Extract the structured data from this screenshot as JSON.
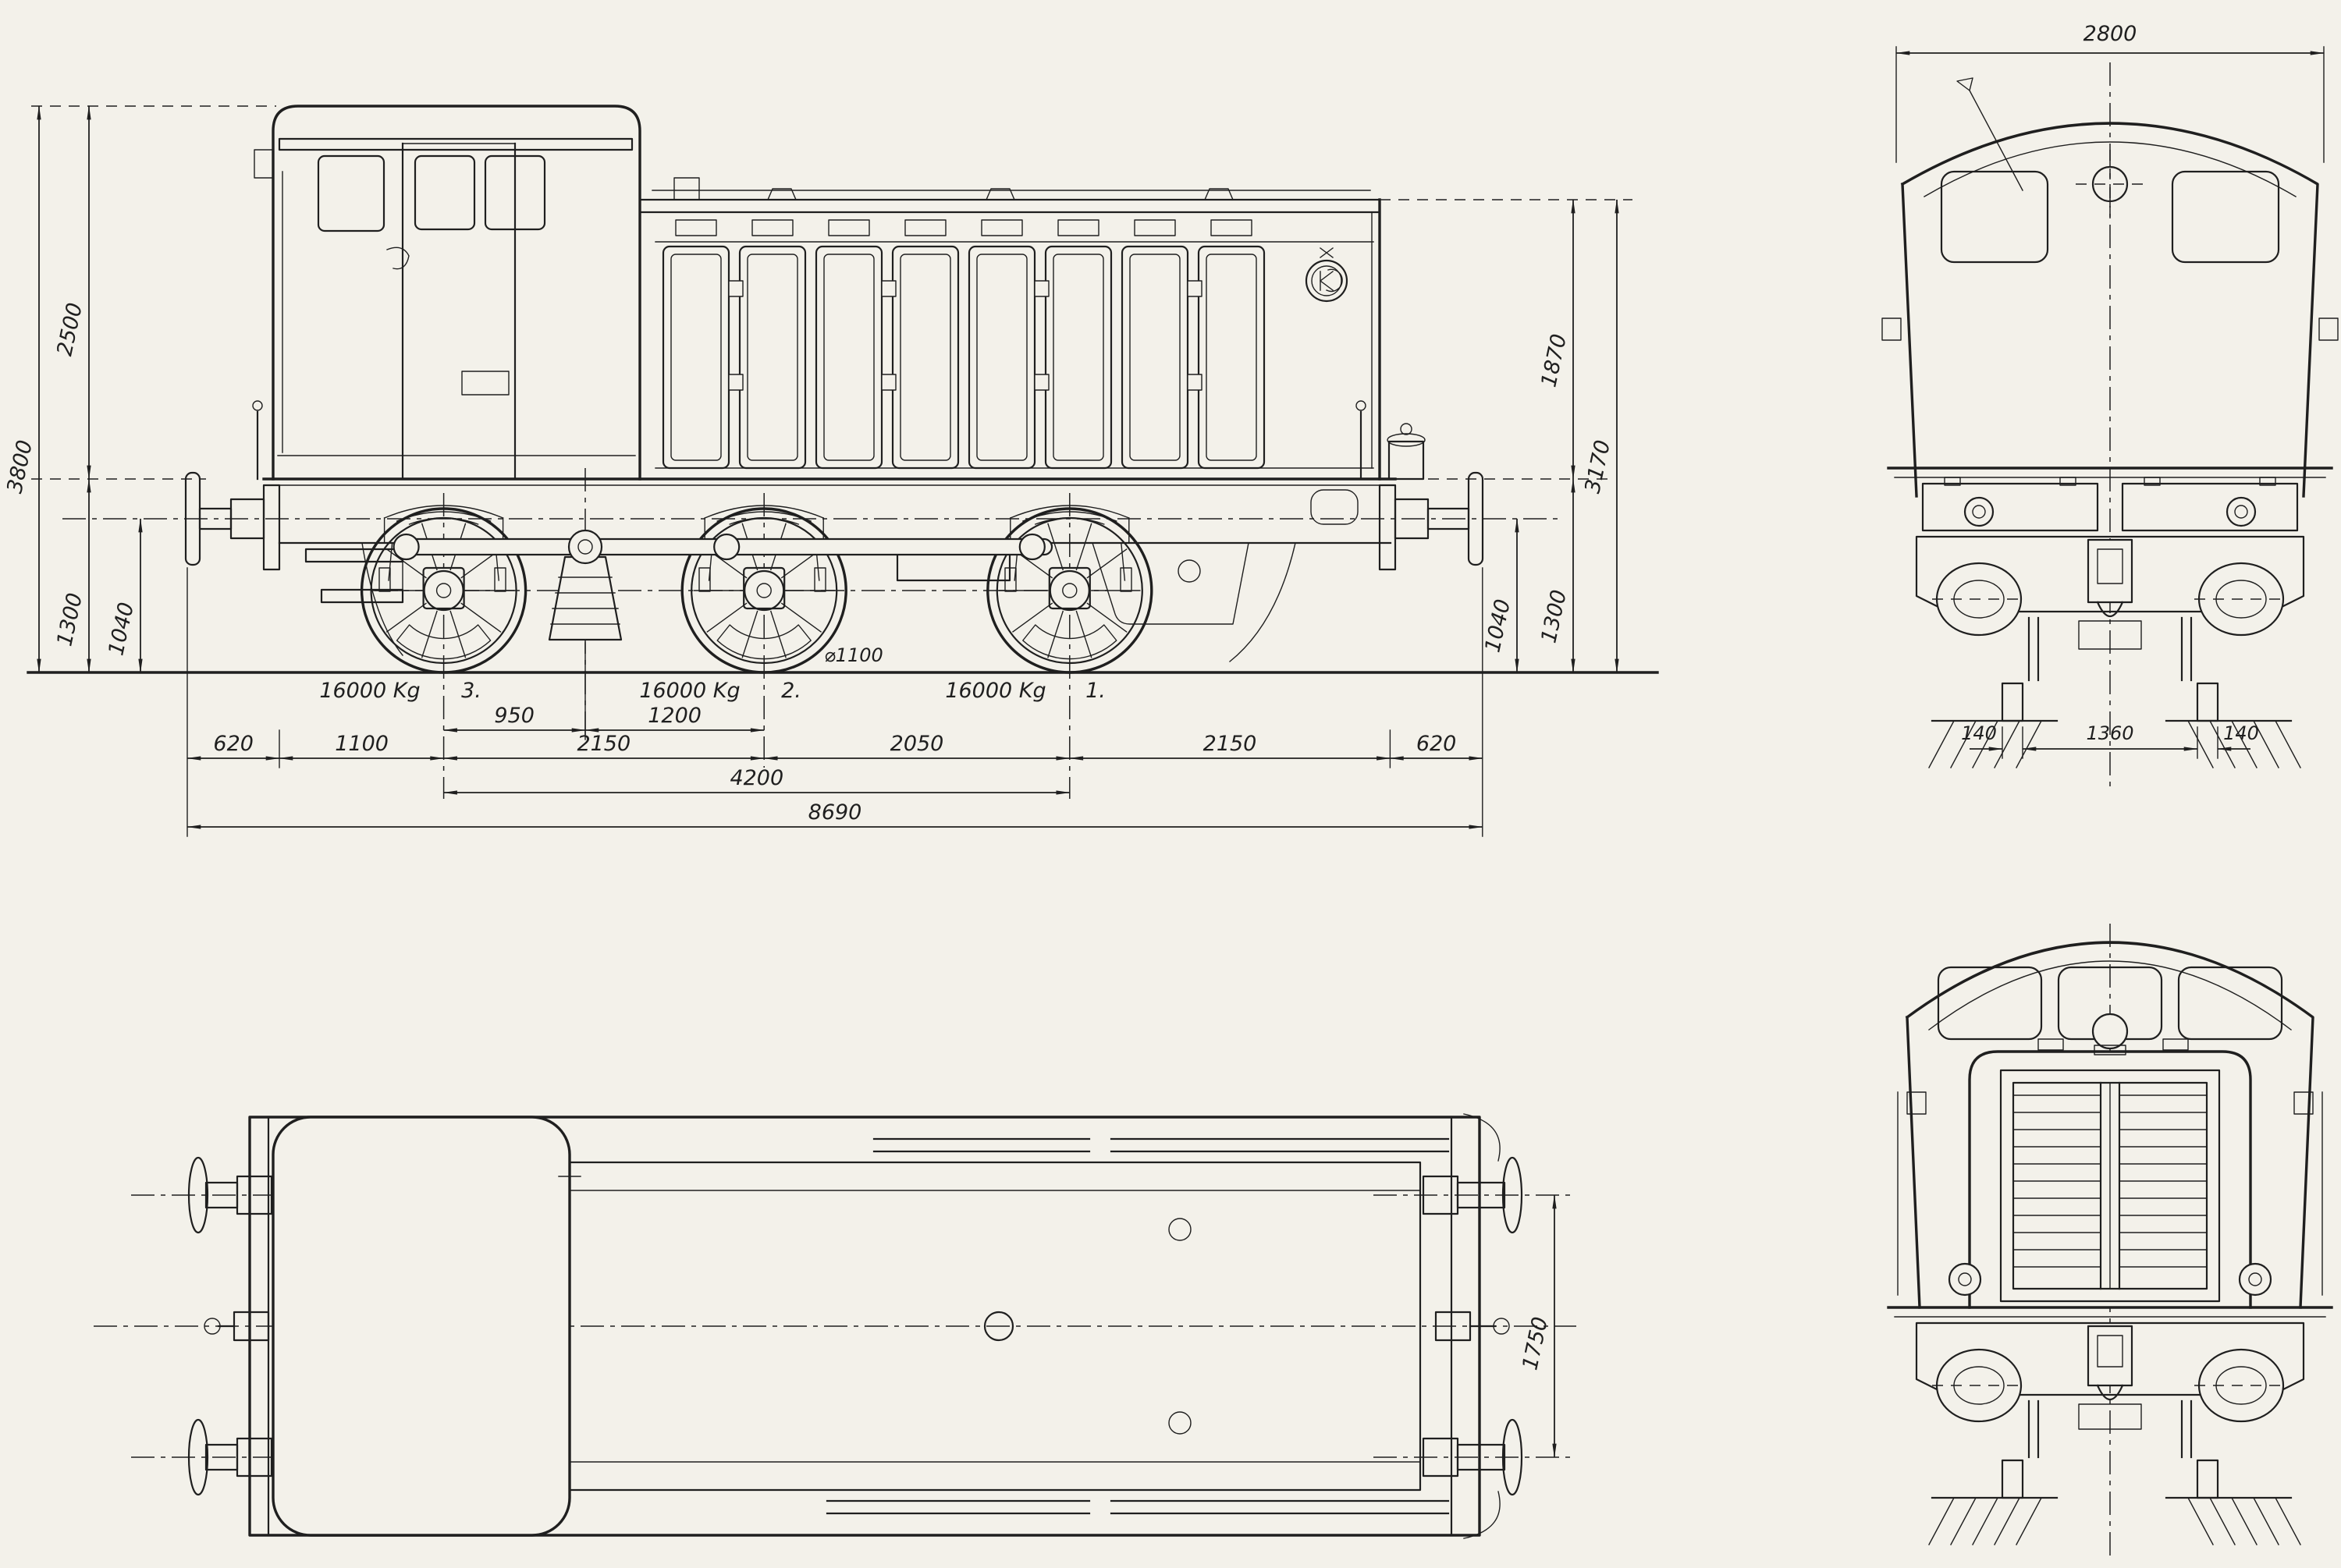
{
  "drawing": {
    "paper_color": "#f3f1ea",
    "ink_color": "#1f1f1f",
    "side_view": {
      "dims_left": {
        "total_height": "3800",
        "cab_height": "2500",
        "frame_height": "1300",
        "buffer_height": "1040"
      },
      "dims_right": {
        "hood_above_frame": "1870",
        "hood_height": "3170",
        "buffer_height": "1040",
        "frame_height": "1300"
      },
      "axle_loads": [
        {
          "weight": "16000 Kg",
          "axle": "3."
        },
        {
          "weight": "16000 Kg",
          "axle": "2."
        },
        {
          "weight": "16000 Kg",
          "axle": "1."
        }
      ],
      "wheel_diameter": "⌀1100",
      "axle_spacing_row": [
        "950",
        "1200"
      ],
      "main_chain": [
        "620",
        "1100",
        "2150",
        "2050",
        "2150",
        "620"
      ],
      "wheelbase_total": "4200",
      "length_overall": "8690"
    },
    "plan_view": {
      "buffer_spacing": "1750"
    },
    "front_view": {
      "body_width": "2800",
      "rail_dims": [
        "140",
        "1360",
        "140"
      ]
    }
  }
}
